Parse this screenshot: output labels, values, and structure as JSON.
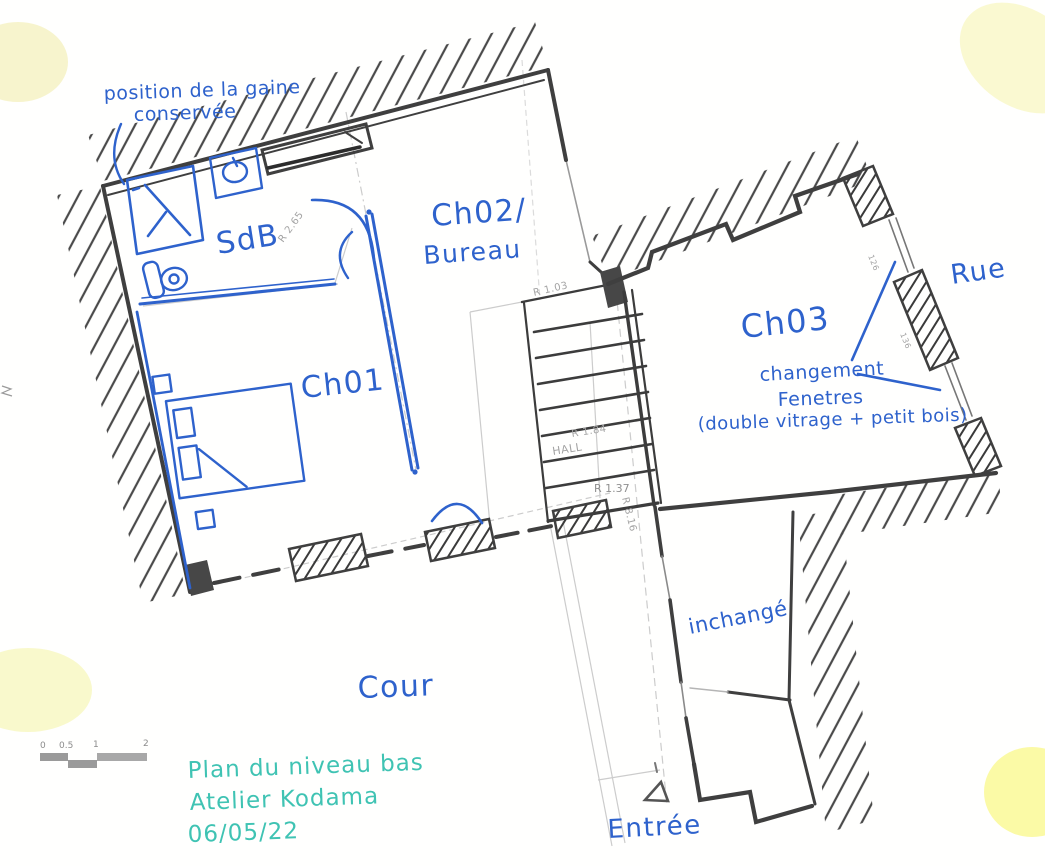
{
  "annotations": {
    "gaine_note_line1": "position de la gaine",
    "gaine_note_line2": "conservée",
    "room_sdb": "SdB",
    "room_ch02": "Ch02/",
    "room_ch02_sub": "Bureau",
    "room_ch01": "Ch01",
    "room_ch03": "Ch03",
    "rue": "Rue",
    "window_note_line1": "changement",
    "window_note_line2": "Fenetres",
    "window_note_line3": "(double vitrage + petit bois)",
    "inchange": "inchangé",
    "cour": "Cour",
    "entree": "Entrée"
  },
  "pencil_notes": {
    "r265": "R 2.65",
    "r103": "R 1.03",
    "r184": "R 1.84",
    "hall": "HALL",
    "r137": "R 1.37",
    "r816": "R 8.16",
    "d126": "126",
    "d136": "136"
  },
  "scale_bar": {
    "ticks": [
      "0",
      "0.5",
      "1",
      "2"
    ]
  },
  "title_block": {
    "line1": "Plan du niveau bas",
    "line2": "Atelier Kodama",
    "line3": "06/05/22"
  },
  "colors": {
    "pen_blue": "#2e62cc",
    "marker_teal": "#3fc3b3",
    "pencil_gray": "#b0b0b0",
    "wall_dark": "#3f3f3f",
    "highlight_yellow": "#f7f4b0"
  }
}
